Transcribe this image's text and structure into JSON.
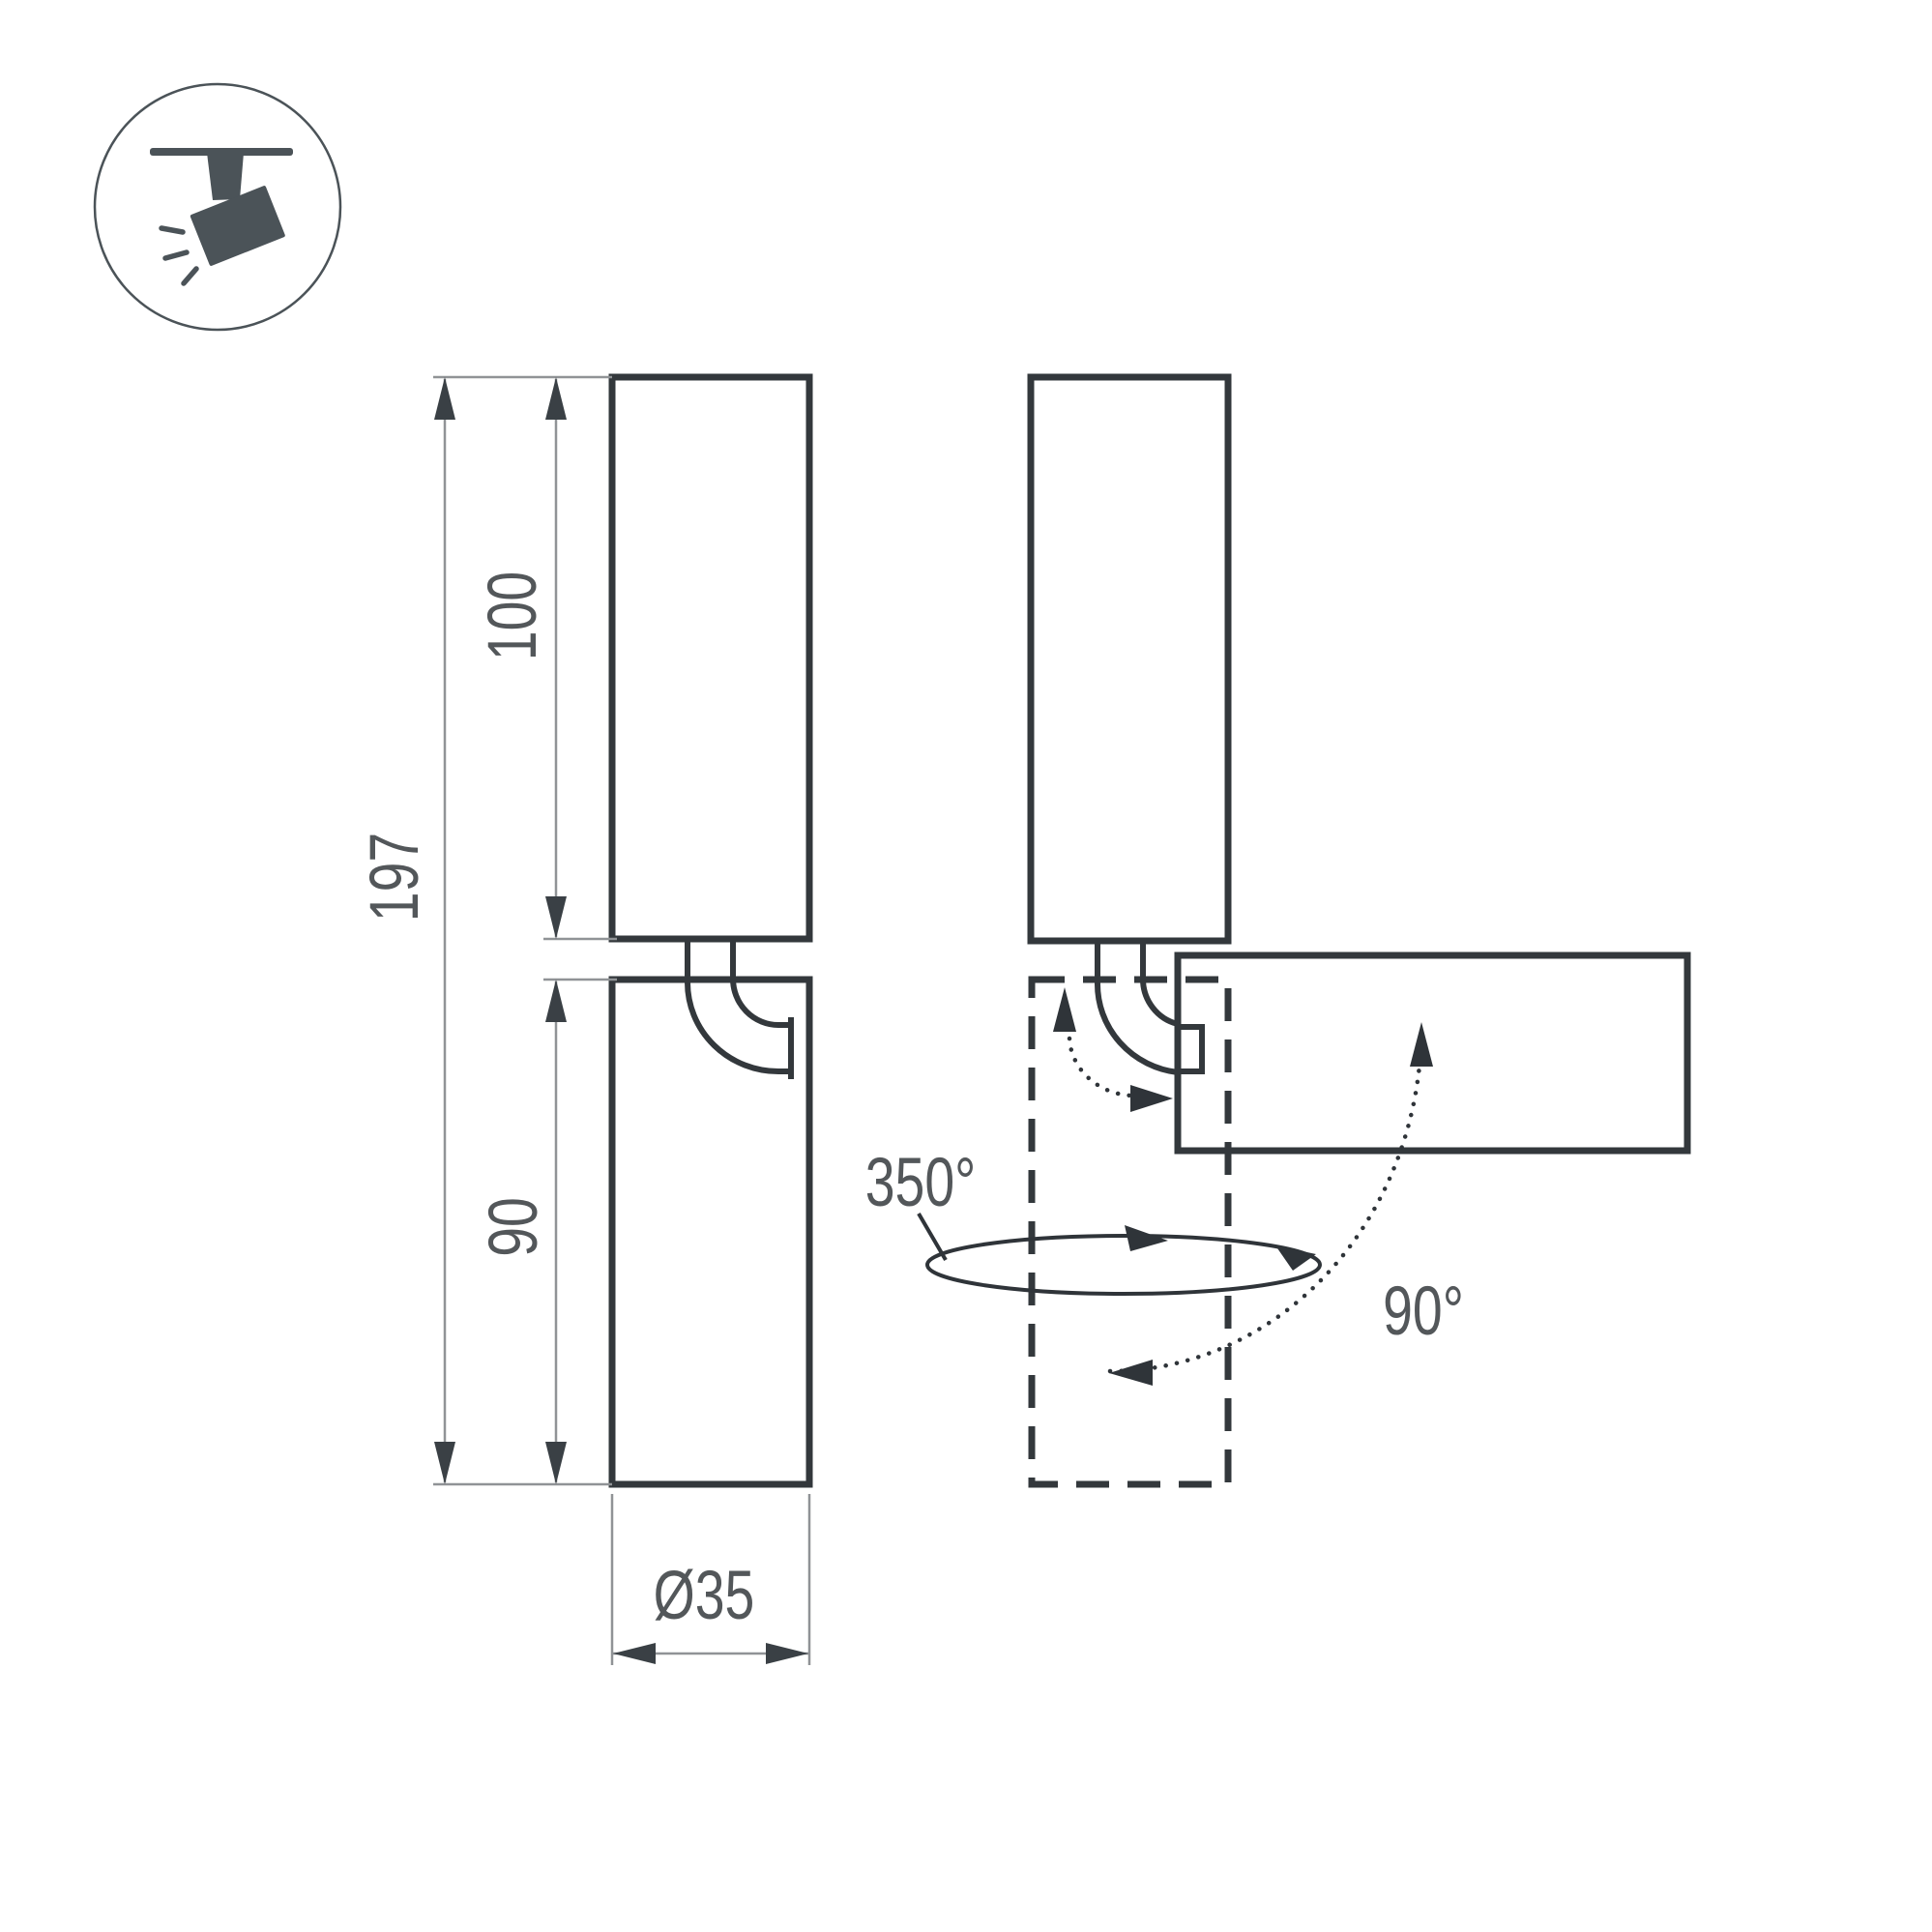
{
  "drawing": {
    "title": "spot luminaire dimension drawing",
    "dimensions": {
      "total_height": "197",
      "upper_section": "100",
      "lower_section": "90",
      "diameter": "Ø35"
    },
    "rotation": {
      "pan": "350°",
      "tilt": "90°"
    }
  },
  "icon": {
    "name": "ceiling-track-spotlight"
  },
  "colors": {
    "background": "#ffffff",
    "outline": "#33383c",
    "dimension_line": "#909396",
    "arrowhead": "#3a4045",
    "annotation": "#2f3439",
    "label_text": "#53575a",
    "icon_fill": "#4b5358"
  }
}
